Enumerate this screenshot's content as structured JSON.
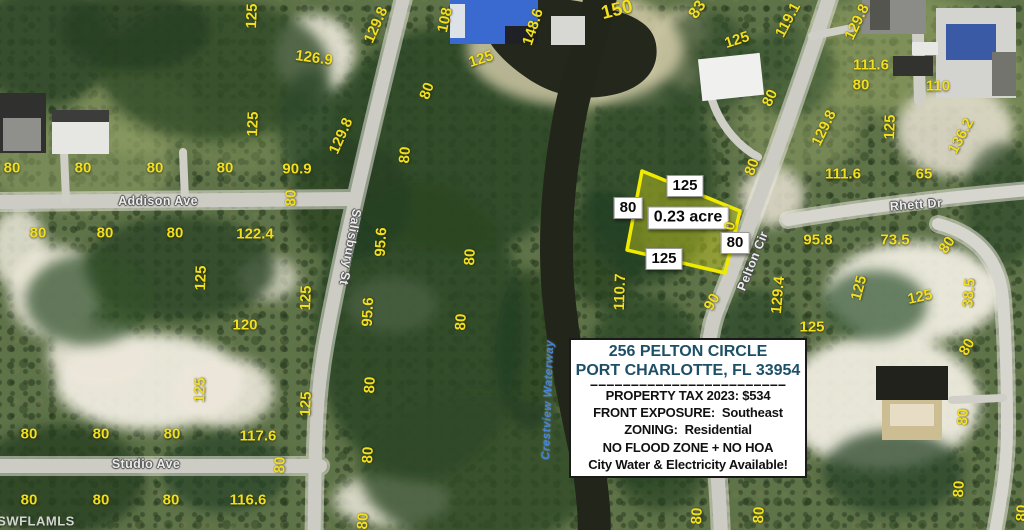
{
  "colors": {
    "dimension_text": "#f2df1f",
    "parcel_outline": "#f0ea00",
    "parcel_fill": "rgba(226,226,30,0.38)",
    "address_text": "#1d4f66",
    "waterway_text": "#4585d8"
  },
  "info_box": {
    "address_line1": "256 PELTON CIRCLE",
    "address_line2": "PORT CHARLOTTE, FL 33954",
    "divider": "========================",
    "tax_line": "PROPERTY TAX 2023: $534",
    "exposure_line": "FRONT EXPOSURE:  Southeast",
    "zoning_line": "ZONING:  Residential",
    "flood_line": "NO FLOOD ZONE + NO HOA",
    "utilities_line": "City Water & Electricity Available!"
  },
  "map": {
    "labels": [
      {
        "t": "street",
        "n": "street-label-addison-ave",
        "text": "Addison Ave",
        "x": 158,
        "y": 201,
        "r": 0
      },
      {
        "t": "street",
        "n": "street-label-salisbury-st",
        "text": "Salisbury St",
        "x": 350,
        "y": 247,
        "r": 100
      },
      {
        "t": "street",
        "n": "street-label-studio-ave",
        "text": "Studio Ave",
        "x": 146,
        "y": 464,
        "r": 0
      },
      {
        "t": "street",
        "n": "street-label-rhett-dr",
        "text": "Rhett Dr",
        "x": 916,
        "y": 205,
        "r": -4
      },
      {
        "t": "street",
        "n": "street-label-pelton-cir",
        "text": "Pelton Cir",
        "x": 753,
        "y": 261,
        "r": -68
      },
      {
        "t": "water",
        "n": "waterway-label",
        "text": "Crestview Waterway",
        "x": 549,
        "y": 400,
        "r": -88
      },
      {
        "t": "wm",
        "n": "watermark",
        "text": "SWFLAMLS",
        "x": 36,
        "y": 521,
        "r": 0
      },
      {
        "t": "box",
        "n": "parcel-frontage-label",
        "text": "125",
        "x": 685,
        "y": 186,
        "r": 0
      },
      {
        "t": "box",
        "n": "parcel-side-left-label",
        "text": "80",
        "x": 628,
        "y": 208,
        "r": 0
      },
      {
        "t": "box",
        "n": "parcel-area-label",
        "text": "0.23 acre",
        "x": 688,
        "y": 218,
        "r": 0,
        "s": 16
      },
      {
        "t": "box",
        "n": "parcel-side-right-label",
        "text": "80",
        "x": 735,
        "y": 243,
        "r": 0
      },
      {
        "t": "box",
        "n": "parcel-rear-label",
        "text": "125",
        "x": 664,
        "y": 259,
        "r": 0
      },
      {
        "t": "dim",
        "text": "125",
        "x": 252,
        "y": 16,
        "r": -88
      },
      {
        "t": "dim",
        "text": "126.9",
        "x": 314,
        "y": 58,
        "r": 8
      },
      {
        "t": "dim",
        "text": "125",
        "x": 253,
        "y": 124,
        "r": -88
      },
      {
        "t": "dim",
        "text": "80",
        "x": 12,
        "y": 168,
        "r": 0
      },
      {
        "t": "dim",
        "text": "80",
        "x": 83,
        "y": 168,
        "r": 0
      },
      {
        "t": "dim",
        "text": "80",
        "x": 155,
        "y": 168,
        "r": 0
      },
      {
        "t": "dim",
        "text": "80",
        "x": 225,
        "y": 168,
        "r": 0
      },
      {
        "t": "dim",
        "text": "90.9",
        "x": 297,
        "y": 169,
        "r": 0
      },
      {
        "t": "dim",
        "text": "80",
        "x": 291,
        "y": 198,
        "r": -88
      },
      {
        "t": "dim",
        "text": "80",
        "x": 38,
        "y": 233,
        "r": 0
      },
      {
        "t": "dim",
        "text": "80",
        "x": 105,
        "y": 233,
        "r": 0
      },
      {
        "t": "dim",
        "text": "80",
        "x": 175,
        "y": 233,
        "r": 0
      },
      {
        "t": "dim",
        "text": "122.4",
        "x": 255,
        "y": 234,
        "r": 0
      },
      {
        "t": "dim",
        "text": "125",
        "x": 201,
        "y": 278,
        "r": -88
      },
      {
        "t": "dim",
        "text": "125",
        "x": 306,
        "y": 298,
        "r": -88
      },
      {
        "t": "dim",
        "text": "120",
        "x": 245,
        "y": 325,
        "r": 0
      },
      {
        "t": "dim",
        "text": "125",
        "x": 200,
        "y": 390,
        "r": -88
      },
      {
        "t": "dim",
        "text": "125",
        "x": 306,
        "y": 404,
        "r": -88
      },
      {
        "t": "dim",
        "text": "80",
        "x": 29,
        "y": 434,
        "r": 0
      },
      {
        "t": "dim",
        "text": "80",
        "x": 101,
        "y": 434,
        "r": 0
      },
      {
        "t": "dim",
        "text": "80",
        "x": 172,
        "y": 434,
        "r": 0
      },
      {
        "t": "dim",
        "text": "117.6",
        "x": 258,
        "y": 436,
        "r": 0
      },
      {
        "t": "dim",
        "text": "80",
        "x": 280,
        "y": 465,
        "r": -88
      },
      {
        "t": "dim",
        "text": "80",
        "x": 29,
        "y": 500,
        "r": 0
      },
      {
        "t": "dim",
        "text": "80",
        "x": 101,
        "y": 500,
        "r": 0
      },
      {
        "t": "dim",
        "text": "80",
        "x": 171,
        "y": 500,
        "r": 0
      },
      {
        "t": "dim",
        "text": "116.6",
        "x": 248,
        "y": 500,
        "r": 0
      },
      {
        "t": "dim",
        "text": "129.8",
        "x": 376,
        "y": 25,
        "r": -66
      },
      {
        "t": "dim",
        "text": "108",
        "x": 445,
        "y": 20,
        "r": -78
      },
      {
        "t": "dim",
        "text": "125",
        "x": 481,
        "y": 59,
        "r": -18
      },
      {
        "t": "dim",
        "text": "148.6",
        "x": 533,
        "y": 27,
        "r": -72
      },
      {
        "t": "dim",
        "text": "150",
        "x": 617,
        "y": 10,
        "r": -14,
        "s": 19
      },
      {
        "t": "dim",
        "text": "83",
        "x": 698,
        "y": 10,
        "r": -55,
        "s": 16
      },
      {
        "t": "dim",
        "text": "80",
        "x": 427,
        "y": 91,
        "r": -70
      },
      {
        "t": "dim",
        "text": "80",
        "x": 405,
        "y": 155,
        "r": -85
      },
      {
        "t": "dim",
        "text": "129.8",
        "x": 341,
        "y": 136,
        "r": -66
      },
      {
        "t": "dim",
        "text": "95.6",
        "x": 381,
        "y": 242,
        "r": -87
      },
      {
        "t": "dim",
        "text": "80",
        "x": 470,
        "y": 257,
        "r": -87
      },
      {
        "t": "dim",
        "text": "80",
        "x": 461,
        "y": 322,
        "r": -87
      },
      {
        "t": "dim",
        "text": "95.6",
        "x": 368,
        "y": 312,
        "r": -87
      },
      {
        "t": "dim",
        "text": "80",
        "x": 370,
        "y": 385,
        "r": -87
      },
      {
        "t": "dim",
        "text": "80",
        "x": 368,
        "y": 455,
        "r": -87
      },
      {
        "t": "dim",
        "text": "80",
        "x": 363,
        "y": 521,
        "r": -87
      },
      {
        "t": "dim",
        "text": "110.7",
        "x": 620,
        "y": 292,
        "r": -88
      },
      {
        "t": "dim",
        "text": "90",
        "x": 712,
        "y": 302,
        "r": -60
      },
      {
        "t": "dim",
        "text": "0",
        "x": 730,
        "y": 226,
        "r": -80
      },
      {
        "t": "dim",
        "text": "125",
        "x": 737,
        "y": 40,
        "r": -18
      },
      {
        "t": "dim",
        "text": "119.1",
        "x": 788,
        "y": 20,
        "r": -62
      },
      {
        "t": "dim",
        "text": "129.8",
        "x": 857,
        "y": 22,
        "r": -64
      },
      {
        "t": "dim",
        "text": "111.6",
        "x": 871,
        "y": 65,
        "r": 0
      },
      {
        "t": "dim",
        "text": "80",
        "x": 861,
        "y": 85,
        "r": 0
      },
      {
        "t": "dim",
        "text": "110",
        "x": 938,
        "y": 86,
        "r": 0
      },
      {
        "t": "dim",
        "text": "80",
        "x": 770,
        "y": 98,
        "r": -65
      },
      {
        "t": "dim",
        "text": "129.8",
        "x": 824,
        "y": 128,
        "r": -64
      },
      {
        "t": "dim",
        "text": "125",
        "x": 890,
        "y": 127,
        "r": -88
      },
      {
        "t": "dim",
        "text": "136.2",
        "x": 961,
        "y": 136,
        "r": -62
      },
      {
        "t": "dim",
        "text": "80",
        "x": 752,
        "y": 167,
        "r": -70
      },
      {
        "t": "dim",
        "text": "111.6",
        "x": 843,
        "y": 174,
        "r": 0
      },
      {
        "t": "dim",
        "text": "65",
        "x": 924,
        "y": 174,
        "r": 0
      },
      {
        "t": "dim",
        "text": "95.8",
        "x": 818,
        "y": 240,
        "r": 0
      },
      {
        "t": "dim",
        "text": "73.5",
        "x": 895,
        "y": 240,
        "r": 0
      },
      {
        "t": "dim",
        "text": "80",
        "x": 947,
        "y": 245,
        "r": -55
      },
      {
        "t": "dim",
        "text": "129.4",
        "x": 778,
        "y": 295,
        "r": -85
      },
      {
        "t": "dim",
        "text": "125",
        "x": 859,
        "y": 288,
        "r": -75
      },
      {
        "t": "dim",
        "text": "38.5",
        "x": 969,
        "y": 293,
        "r": -85
      },
      {
        "t": "dim",
        "text": "125",
        "x": 920,
        "y": 297,
        "r": -12
      },
      {
        "t": "dim",
        "text": "125",
        "x": 812,
        "y": 327,
        "r": 0
      },
      {
        "t": "dim",
        "text": "80",
        "x": 967,
        "y": 347,
        "r": -60
      },
      {
        "t": "dim",
        "text": "80",
        "x": 963,
        "y": 417,
        "r": -87
      },
      {
        "t": "dim",
        "text": "80",
        "x": 959,
        "y": 489,
        "r": -87
      },
      {
        "t": "dim",
        "text": "80",
        "x": 697,
        "y": 516,
        "r": -87
      },
      {
        "t": "dim",
        "text": "80",
        "x": 759,
        "y": 515,
        "r": -87
      },
      {
        "t": "dim",
        "text": "80",
        "x": 1022,
        "y": 513,
        "r": -87
      }
    ]
  }
}
